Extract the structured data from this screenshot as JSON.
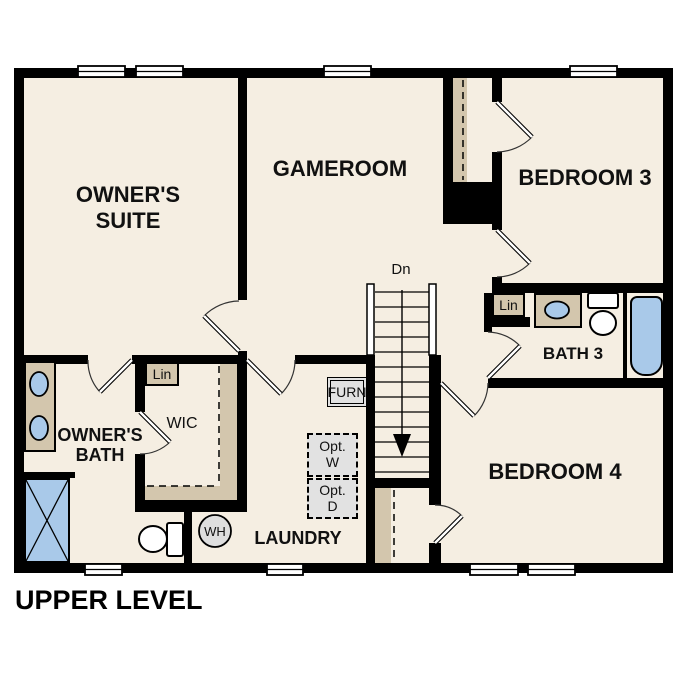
{
  "floorplan": {
    "title": "UPPER LEVEL",
    "rooms": {
      "owners_suite": {
        "line1": "OWNER'S",
        "line2": "SUITE"
      },
      "gameroom": {
        "label": "GAMEROOM"
      },
      "bedroom3": {
        "label": "BEDROOM 3"
      },
      "bath3": {
        "label": "BATH 3"
      },
      "bedroom4": {
        "label": "BEDROOM 4"
      },
      "laundry": {
        "label": "LAUNDRY"
      },
      "owners_bath": {
        "line1": "OWNER'S",
        "line2": "BATH"
      },
      "wic": {
        "label": "WIC"
      }
    },
    "closets": {
      "linen_owners": {
        "label": "Lin"
      },
      "linen_bath3": {
        "label": "Lin"
      }
    },
    "equipment": {
      "furnace": {
        "label": "FURN"
      },
      "water_heater": {
        "label": "WH"
      },
      "optional_washer": {
        "line1": "Opt.",
        "line2": "W"
      },
      "optional_dryer": {
        "line1": "Opt.",
        "line2": "D"
      }
    },
    "stairs": {
      "direction_label": "Dn"
    },
    "colors": {
      "floor": "#f5eee2",
      "walls": "#000000",
      "casework_tan": "#d3c6ad",
      "fixture_blue": "#a9c9e9",
      "equipment_gray": "#e2e2e2",
      "background": "#ffffff"
    }
  }
}
